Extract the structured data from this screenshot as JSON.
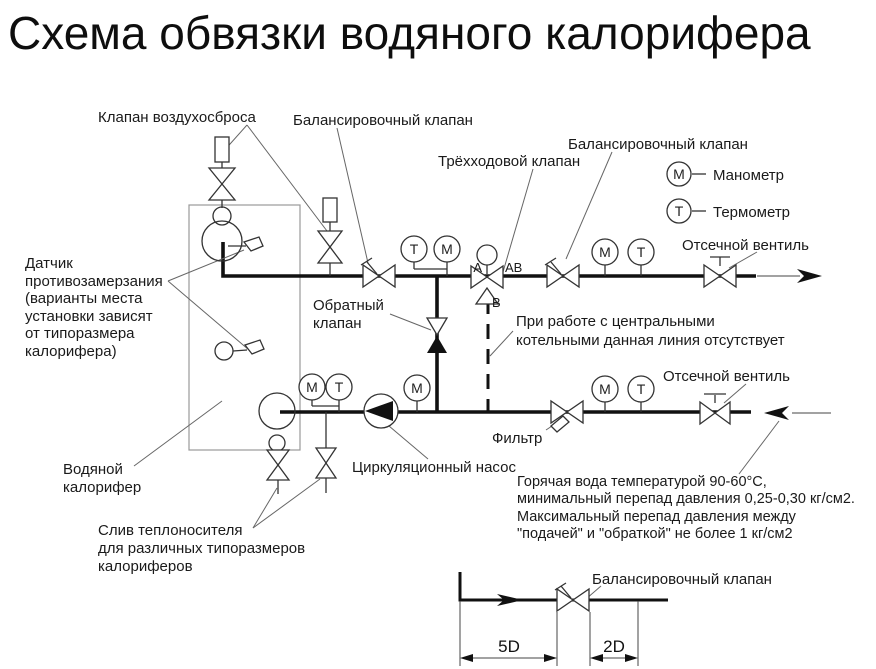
{
  "title": "Схема обвязки водяного калорифера",
  "labels": {
    "air_vent": "Клапан воздухосброса",
    "balancing_1": "Балансировочный клапан",
    "three_way": "Трёхходовой клапан",
    "balancing_2": "Балансировочный клапан",
    "shutoff_top": "Отсечной вентиль",
    "shutoff_bottom": "Отсечной вентиль",
    "check_1": "Обратный",
    "check_2": "клапан",
    "filter": "Фильтр",
    "pump": "Циркуляционный насос",
    "heater_1": "Водяной",
    "heater_2": "калорифер",
    "balancing_detail": "Балансировочный  клапан"
  },
  "notes": {
    "sensor": [
      "Датчик",
      "противозамерзания",
      "(варианты места",
      "установки зависят",
      "от типоразмера",
      "калорифера)"
    ],
    "drain": [
      "Слив теплоносителя",
      "для различных типоразмеров",
      "калориферов"
    ],
    "bypass": [
      "При работе с центральными",
      "котельными данная линия отсутствует"
    ],
    "water": [
      "Горячая вода температурой 90-60°C,",
      "минимальный перепад давления 0,25-0,30 кг/см2.",
      "Максимальный перепад давления между",
      "\"подачей\" и \"обраткой\" не более 1 кг/см2"
    ]
  },
  "legend": {
    "m_symbol": "М",
    "m_label": "Манометр",
    "t_symbol": "Т",
    "t_label": "Термометр"
  },
  "gauges": {
    "m": "М",
    "t": "Т"
  },
  "ports": {
    "a": "А",
    "ab": "АВ",
    "b": "В"
  },
  "dimensions": {
    "d5": "5D",
    "d2": "2D"
  },
  "colors": {
    "pipe": "#111111",
    "symbol": "#333333",
    "background": "#ffffff"
  }
}
